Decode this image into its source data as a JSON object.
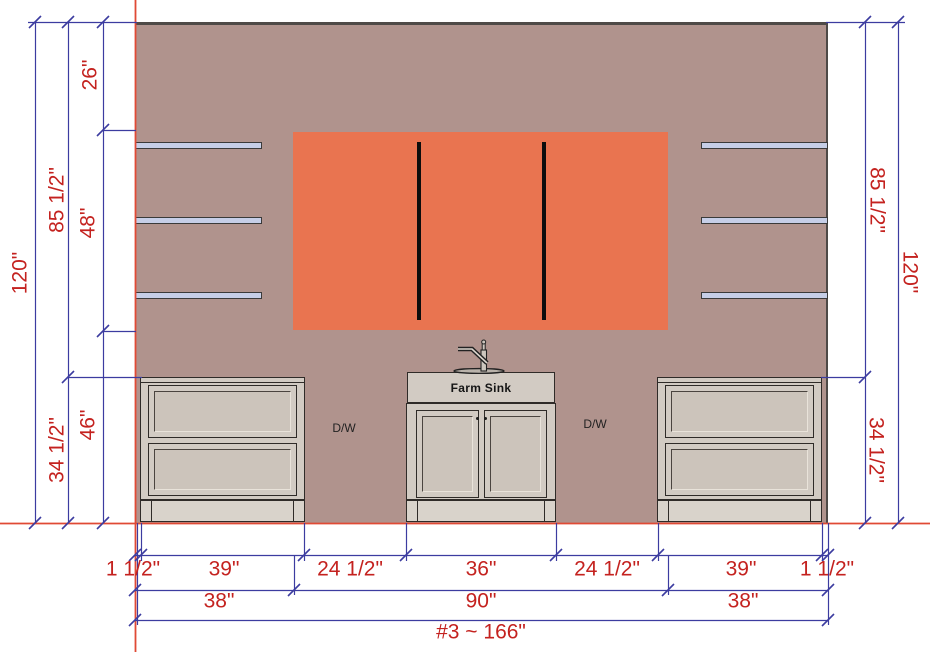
{
  "drawing_name": "#3 ~ 166\"",
  "colors": {
    "wall": "#b0938d",
    "orange": "#e97450",
    "shelf": "#c6cee7",
    "cabinet": "#d2cbc3",
    "dimline": "#3c3ca0",
    "dimtext": "#c4221f",
    "construction": "#e04a35"
  },
  "labels": {
    "farm_sink": "Farm Sink",
    "dishwasher_left": "D/W",
    "dishwasher_right": "D/W"
  },
  "dimensions": {
    "left": [
      {
        "label": "120\"",
        "x": 20,
        "y": 273,
        "rot": "vl"
      },
      {
        "label": "85 1/2\"",
        "x": 57,
        "y": 200,
        "rot": "vl"
      },
      {
        "label": "26\"",
        "x": 90,
        "y": 75,
        "rot": "vl"
      },
      {
        "label": "48\"",
        "x": 88,
        "y": 223,
        "rot": "vl"
      },
      {
        "label": "34 1/2\"",
        "x": 57,
        "y": 450,
        "rot": "vl"
      },
      {
        "label": "46\"",
        "x": 88,
        "y": 425,
        "rot": "vl"
      }
    ],
    "right": [
      {
        "label": "85 1/2\"",
        "x": 877,
        "y": 200,
        "rot": "vr"
      },
      {
        "label": "120\"",
        "x": 910,
        "y": 272,
        "rot": "vr"
      },
      {
        "label": "34 1/2\"",
        "x": 876,
        "y": 450,
        "rot": "vr"
      }
    ],
    "bottom_row1": [
      {
        "label": "1 1/2\"",
        "x": 133,
        "y": 569
      },
      {
        "label": "39\"",
        "x": 224,
        "y": 569
      },
      {
        "label": "24 1/2\"",
        "x": 350,
        "y": 569
      },
      {
        "label": "36\"",
        "x": 481,
        "y": 569
      },
      {
        "label": "24 1/2\"",
        "x": 607,
        "y": 569
      },
      {
        "label": "39\"",
        "x": 741,
        "y": 569
      },
      {
        "label": "1 1/2\"",
        "x": 827,
        "y": 569
      }
    ],
    "bottom_row2": [
      {
        "label": "38\"",
        "x": 219,
        "y": 601
      },
      {
        "label": "90\"",
        "x": 481,
        "y": 601
      },
      {
        "label": "38\"",
        "x": 743,
        "y": 601
      }
    ],
    "bottom_row3": [
      {
        "label": "#3 ~ 166\"",
        "x": 481,
        "y": 632
      }
    ]
  }
}
